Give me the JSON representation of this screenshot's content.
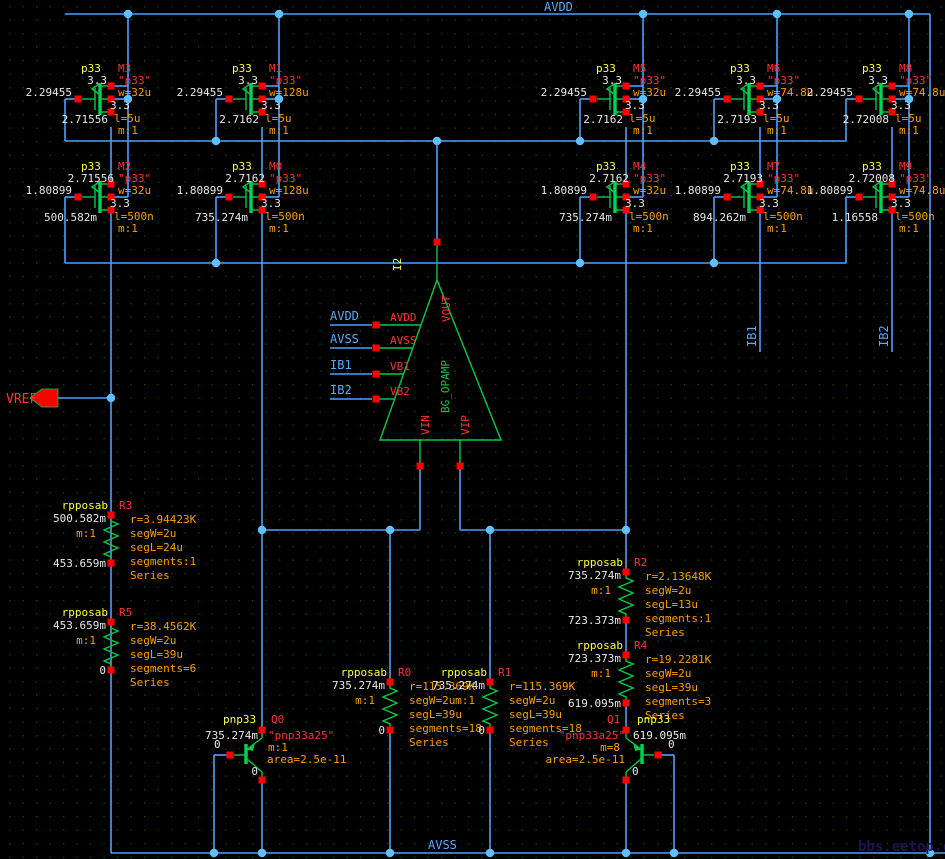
{
  "watermark": "bbs.eetop.cn",
  "nets": {
    "avdd": "AVDD",
    "avss": "AVSS",
    "vref": "VREF",
    "ib1": "IB1",
    "ib2": "IB2"
  },
  "opamp": {
    "instance": "I2",
    "cell": "BG_OPAMP",
    "pins": {
      "vout": "VOUT",
      "avdd": "AVDD",
      "avss": "AVSS",
      "vb1": "VB1",
      "vb2": "VB2",
      "vin": "VIN",
      "vip": "VIP"
    },
    "nets": {
      "avdd": "AVDD",
      "avss": "AVSS",
      "ib1": "IB1",
      "ib2": "IB2"
    }
  },
  "mosfets": [
    {
      "name": "M3",
      "cell": "p33",
      "model": "\"p33\"",
      "v1": "3.3",
      "gate": "2.29455",
      "v2": "2.71556",
      "w": "w=32u",
      "l": "l=5u",
      "m": "m:1",
      "bulk": "3.3"
    },
    {
      "name": "M2",
      "cell": "p33",
      "model": "\"p33\"",
      "v1": "2.71556",
      "gate": "1.80899",
      "v2": "500.582m",
      "w": "w=32u",
      "l": "l=500n",
      "m": "m:1",
      "bulk": "3.3"
    },
    {
      "name": "M1",
      "cell": "p33",
      "model": "\"p33\"",
      "v1": "3.3",
      "gate": "2.29455",
      "v2": "2.7162",
      "w": "w=128u",
      "l": "l=5u",
      "m": "m:1",
      "bulk": "3.3"
    },
    {
      "name": "M0",
      "cell": "p33",
      "model": "\"p33\"",
      "v1": "2.7162",
      "gate": "1.80899",
      "v2": "735.274m",
      "w": "w=128u",
      "l": "l=500n",
      "m": "m:1",
      "bulk": "3.3"
    },
    {
      "name": "M5",
      "cell": "p33",
      "model": "\"p33\"",
      "v1": "3.3",
      "gate": "2.29455",
      "v2": "2.7162",
      "w": "w=32u",
      "l": "l=5u",
      "m": "m:1",
      "bulk": "3.3"
    },
    {
      "name": "M4",
      "cell": "p33",
      "model": "\"p33\"",
      "v1": "2.7162",
      "gate": "1.80899",
      "v2": "735.274m",
      "w": "w=32u",
      "l": "l=500n",
      "m": "m:1",
      "bulk": "3.3"
    },
    {
      "name": "M6",
      "cell": "p33",
      "model": "\"p33\"",
      "v1": "3.3",
      "gate": "2.29455",
      "v2": "2.7193",
      "w": "w=74.8u",
      "l": "l=5u",
      "m": "m:1",
      "bulk": "3.3"
    },
    {
      "name": "M7",
      "cell": "p33",
      "model": "\"p33\"",
      "v1": "2.7193",
      "gate": "1.80899",
      "v2": "894.262m",
      "w": "w=74.8u",
      "l": "l=500n",
      "m": "m:1",
      "bulk": "3.3"
    },
    {
      "name": "M8",
      "cell": "p33",
      "model": "\"p33\"",
      "v1": "3.3",
      "gate": "2.29455",
      "v2": "2.72008",
      "w": "w=74.8u",
      "l": "l=5u",
      "m": "m:1",
      "bulk": "3.3"
    },
    {
      "name": "M9",
      "cell": "p33",
      "model": "\"p33\"",
      "v1": "2.72008",
      "gate": "1.80899",
      "v2": "1.16558",
      "w": "w=74.8u",
      "l": "l=500n",
      "m": "m:1",
      "bulk": "3.3"
    }
  ],
  "resistors": [
    {
      "name": "R3",
      "cell": "rpposab",
      "v_top": "500.582m",
      "m": "m:1",
      "r": "r=3.94423K",
      "segw": "segW=2u",
      "segl": "segL=24u",
      "segments": "segments:1",
      "series": "Series",
      "v_bot": "453.659m"
    },
    {
      "name": "R5",
      "cell": "rpposab",
      "v_top": "453.659m",
      "m": "m:1",
      "r": "r=38.4562K",
      "segw": "segW=2u",
      "segl": "segL=39u",
      "segments": "segments=6",
      "series": "Series",
      "v_bot": "0"
    },
    {
      "name": "R0",
      "cell": "rpposab",
      "v_top": "735.274m",
      "m": "m:1",
      "r": "r=115.369K",
      "segw": "segW=2u",
      "segl": "segL=39u",
      "segments": "segments=18",
      "series": "Series",
      "v_bot": "0"
    },
    {
      "name": "R1",
      "cell": "rpposab",
      "v_top": "735.274m",
      "m": "m:1",
      "r": "r=115.369K",
      "segw": "segW=2u",
      "segl": "segL=39u",
      "segments": "segments=18",
      "series": "Series",
      "v_bot": "0"
    },
    {
      "name": "R2",
      "cell": "rpposab",
      "v_top": "735.274m",
      "m": "m:1",
      "r": "r=2.13648K",
      "segw": "segW=2u",
      "segl": "segL=13u",
      "segments": "segments:1",
      "series": "Series",
      "v_bot": "723.373m"
    },
    {
      "name": "R4",
      "cell": "rpposab",
      "v_top": "723.373m",
      "m": "m:1",
      "r": "r=19.2281K",
      "segw": "segW=2u",
      "segl": "segL=39u",
      "segments": "segments=3",
      "series": "Series",
      "v_bot": "619.095m"
    }
  ],
  "bjts": [
    {
      "name": "Q0",
      "cell": "pnp33",
      "v_top": "735.274m",
      "model": "\"pnp33a25\"",
      "m": "m:1",
      "area": "area=2.5e-11",
      "v_base": "0",
      "v_bot": "0"
    },
    {
      "name": "Q1",
      "cell": "pnp33",
      "v_top": "619.095m",
      "model": "\"pnp33a25\"",
      "m": "m=8",
      "area": "area=2.5e-11",
      "v_base": "0",
      "v_bot": "0"
    }
  ],
  "colors": {
    "wire": "#4aa0ff",
    "device": "#00cc44",
    "pin": "#ff0000",
    "annotation": "#e8e8e8",
    "param": "#ff9e00",
    "cell": "#ffff33",
    "instance": "#ff3030",
    "netlabel": "#58aaff"
  }
}
